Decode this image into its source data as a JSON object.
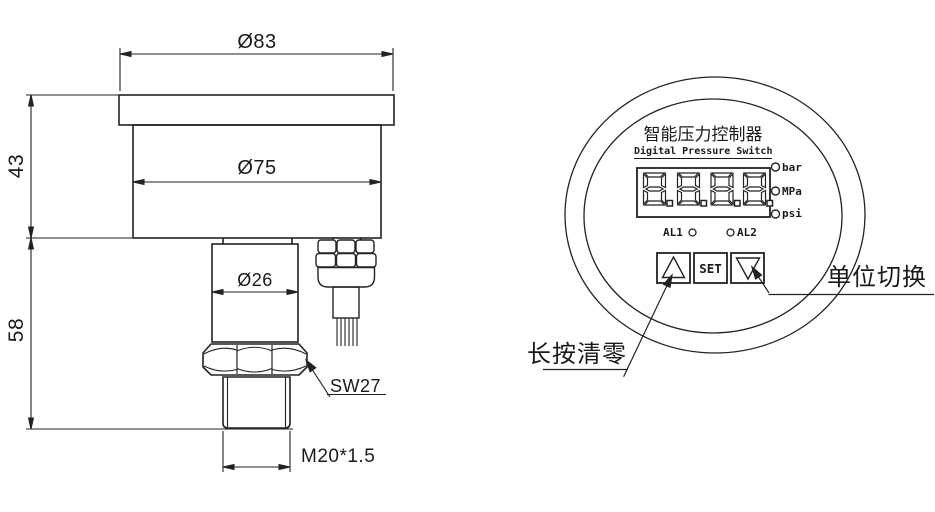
{
  "drawing_title": "Digital Pressure Switch dimensional drawing",
  "side_view": {
    "dim_top_flange_diameter": "Ø83",
    "dim_body_diameter": "Ø75",
    "dim_neck_diameter": "Ø26",
    "dim_upper_height": "43",
    "dim_lower_height": "58",
    "wrench_size_label": "SW27",
    "thread_label": "M20*1.5"
  },
  "front_view": {
    "title_cn": "智能压力控制器",
    "title_en": "Digital Pressure Switch",
    "display_value": "8.8.8.8.",
    "unit_labels": [
      "bar",
      "MPa",
      "psi"
    ],
    "alarm_labels": [
      "AL1",
      "AL2"
    ],
    "button_up_symbol": "△",
    "button_set_label": "SET",
    "button_down_symbol": "▽",
    "annotation_unit_switch": "单位切换",
    "annotation_long_press_zero": "长按清零"
  },
  "colors": {
    "line": "#222222",
    "text": "#1a1a1a",
    "background": "#ffffff"
  }
}
